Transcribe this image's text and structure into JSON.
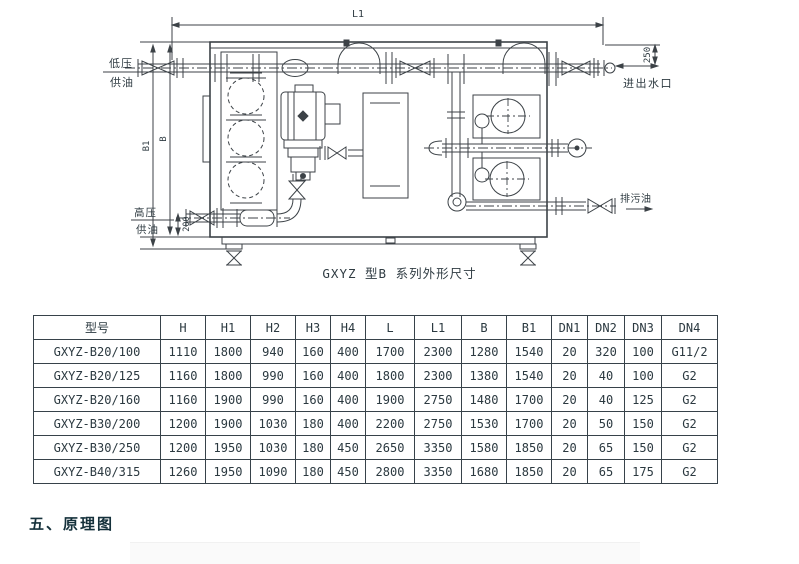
{
  "diagram": {
    "caption": "GXYZ 型B 系列外形尺寸",
    "labels": {
      "l1": "L1",
      "d250": "250",
      "b1": "B1",
      "b": "B",
      "d200": "200",
      "low_pressure": "低压",
      "low_supply": "供油",
      "high_pressure": "高压",
      "high_supply": "供油",
      "water_inlet_outlet": "进出水口",
      "drain_oil": "排污油"
    }
  },
  "table": {
    "headers": [
      "型号",
      "H",
      "H1",
      "H2",
      "H3",
      "H4",
      "L",
      "L1",
      "B",
      "B1",
      "DN1",
      "DN2",
      "DN3",
      "DN4"
    ],
    "rows": [
      [
        "GXYZ-B20/100",
        "1110",
        "1800",
        "940",
        "160",
        "400",
        "1700",
        "2300",
        "1280",
        "1540",
        "20",
        "320",
        "100",
        "G11/2"
      ],
      [
        "GXYZ-B20/125",
        "1160",
        "1800",
        "990",
        "160",
        "400",
        "1800",
        "2300",
        "1380",
        "1540",
        "20",
        "40",
        "100",
        "G2"
      ],
      [
        "GXYZ-B20/160",
        "1160",
        "1900",
        "990",
        "160",
        "400",
        "1900",
        "2750",
        "1480",
        "1700",
        "20",
        "40",
        "125",
        "G2"
      ],
      [
        "GXYZ-B30/200",
        "1200",
        "1900",
        "1030",
        "180",
        "400",
        "2200",
        "2750",
        "1530",
        "1700",
        "20",
        "50",
        "150",
        "G2"
      ],
      [
        "GXYZ-B30/250",
        "1200",
        "1950",
        "1030",
        "180",
        "450",
        "2650",
        "3350",
        "1580",
        "1850",
        "20",
        "65",
        "150",
        "G2"
      ],
      [
        "GXYZ-B40/315",
        "1260",
        "1950",
        "1090",
        "180",
        "450",
        "2800",
        "3350",
        "1680",
        "1850",
        "20",
        "65",
        "175",
        "G2"
      ]
    ]
  },
  "section_heading": "五、原理图",
  "colors": {
    "ink": "#2f3b42",
    "table_border": "#37424a",
    "heading": "#15313b"
  }
}
